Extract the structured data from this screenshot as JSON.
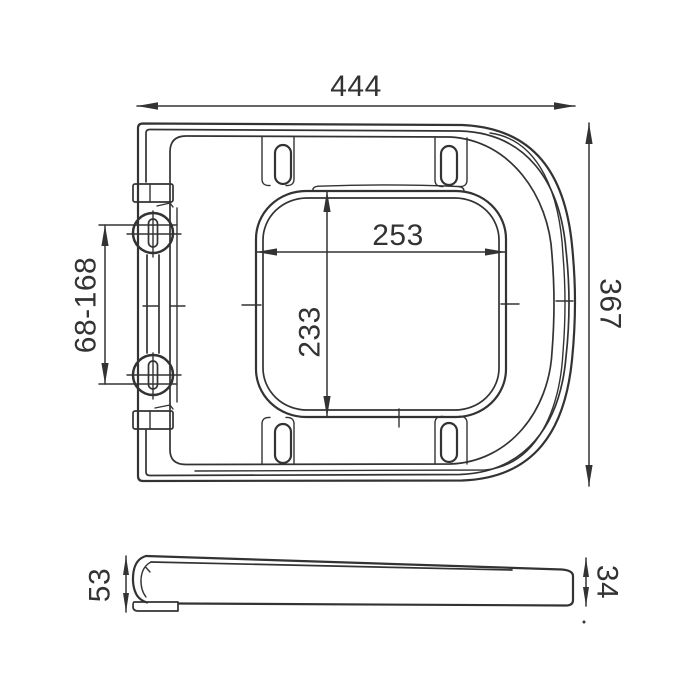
{
  "drawing": {
    "colors": {
      "line": "#333333",
      "background": "#ffffff"
    },
    "top_view": {
      "overall_width": "444",
      "overall_depth": "367",
      "cutout_width": "253",
      "cutout_depth": "233",
      "hinge_spacing": "68-168"
    },
    "side_view": {
      "front_height": "53",
      "rear_height": "34"
    }
  }
}
